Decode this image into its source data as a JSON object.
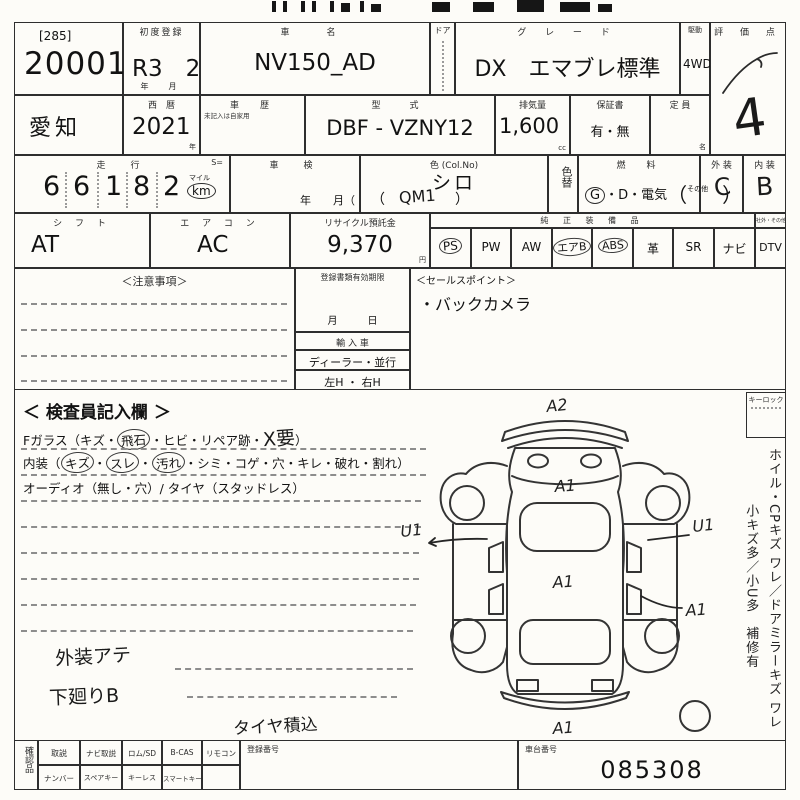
{
  "colors": {
    "paper": "#fdfcf8",
    "ink": "#2e2e2e",
    "pen": "#1a1a1a"
  },
  "row1": {
    "lot_prefix": "[285]",
    "lot_number": "20001",
    "first_reg_label": "初度登録",
    "first_reg_value": "R3　2",
    "first_reg_units": "年　月",
    "car_name_label": "車　名",
    "car_name": "NV150_AD",
    "door_label": "ドア",
    "grade_label": "グ レ ー ド",
    "grade": "DX　エマブレ標準",
    "drive_label": "駆動",
    "drive": "4WD",
    "score_label": "評 価 点",
    "score_value": "4"
  },
  "row2": {
    "prefecture": "愛知",
    "year_label": "西　暦",
    "year": "2021",
    "year_unit": "年",
    "history_label": "車　歴",
    "history_note": "未記入は自家用",
    "model_label": "型　式",
    "model": "DBF - VZNY12",
    "displacement_label": "排気量",
    "displacement": "1,600",
    "displacement_unit": "cc",
    "warranty_label": "保証書",
    "warranty": "有・無",
    "capacity_label": "定 員",
    "capacity_unit": "名"
  },
  "row3": {
    "mileage_label": "走　行",
    "s_label": "S=",
    "mileage_digits": [
      "6",
      "6",
      "1",
      "8",
      "2"
    ],
    "mile_label": "マイル",
    "km_label": "km",
    "inspection_label": "車　検",
    "inspection_suffix": "年　　月（",
    "color_label": "色 (Col.No)",
    "color": "シロ",
    "color_paren": "（　　　　　）",
    "color_code_hand": "QM1",
    "color_change_label": "色替",
    "fuel_label": "燃　料",
    "fuel_g": "G",
    "fuel_rest": "・D・電気",
    "fuel_open": "（",
    "fuel_other": "その他",
    "fuel_close": "）",
    "exterior_label": "外 装",
    "exterior_grade": "C",
    "interior_label": "内 装",
    "interior_grade": "B"
  },
  "row4": {
    "shift_label": "シ フ ト",
    "shift": "AT",
    "ac_label": "エ ア コ ン",
    "ac": "AC",
    "recycle_label": "リサイクル預託金",
    "recycle_fee": "9,370",
    "yen": "円",
    "equipment_label": "純 正 装 備 品",
    "equipment": [
      {
        "label": "PS",
        "circled": true
      },
      {
        "label": "PW",
        "circled": false
      },
      {
        "label": "AW",
        "circled": false
      },
      {
        "label": "エアB",
        "circled": true
      },
      {
        "label": "ABS",
        "circled": true
      },
      {
        "label": "革",
        "circled": false
      },
      {
        "label": "SR",
        "circled": false
      },
      {
        "label": "ナビ",
        "circled": false
      }
    ],
    "dtv_header": "社外・その他",
    "dtv": "DTV"
  },
  "row5": {
    "notes_label": "＜注意事項＞",
    "docs_label": "登録書類有効期限",
    "docs_units": "月　　　日",
    "import_label": "輸 入 車",
    "dealer_label": "ディーラー・並行",
    "handle_label": "左H ・ 右H",
    "sales_label": "＜セールスポイント＞",
    "sales_point": "・バックカメラ"
  },
  "inspector": {
    "title": "＜ 検査員記入欄 ＞",
    "fglass_pre": "Fガラス（キズ・",
    "fglass_circled": "飛石",
    "fglass_mid": "・ヒビ・リペア跡・",
    "fglass_hand": "X要",
    "fglass_close": "）",
    "interior_pre": "内装（",
    "interior_c1": "キズ",
    "interior_c2": "スレ",
    "interior_c3": "汚れ",
    "sep": "・",
    "interior_rest": "・シミ・コゲ・穴・キレ・破れ・割れ）",
    "audio_line": "オーディオ（無し・穴）/ タイヤ（スタッドレス）",
    "hand_note1": "外装アテ",
    "hand_note2": "下廻りB",
    "hand_note3": "タイヤ積込"
  },
  "diagram": {
    "marks": [
      {
        "label": "A2",
        "pos": "front-top"
      },
      {
        "label": "A1",
        "pos": "hood"
      },
      {
        "label": "U1",
        "pos": "left-side"
      },
      {
        "label": "U1",
        "pos": "right-side"
      },
      {
        "label": "A1",
        "pos": "roof"
      },
      {
        "label": "A1",
        "pos": "right-rear"
      },
      {
        "label": "A1",
        "pos": "rear-bottom"
      }
    ]
  },
  "sidebar": {
    "keylock_label": "キーロック",
    "vertical_note": "ホイル・CPキズ ワレ／ドアミラーキズ ワレ\n　　　　小キズ多／小U多　補修有"
  },
  "bottom": {
    "check_label": "確認品",
    "row1": [
      "取説",
      "ナビ取説",
      "ロム/SD",
      "B-CAS",
      "リモコン"
    ],
    "row2": [
      "ナンバー",
      "スペアキー",
      "キーレス",
      "スマートキー"
    ],
    "reg_no_label": "登録番号",
    "chassis_label": "車台番号",
    "chassis_no": "085308"
  }
}
